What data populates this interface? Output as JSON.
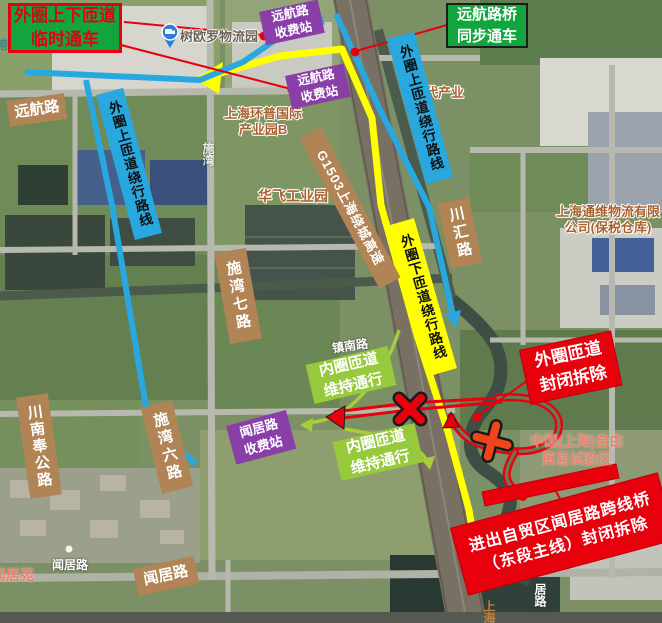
{
  "colors": {
    "notice_green": "#12a53e",
    "closure_red": "#e8000d",
    "detour_blue": "#29a8e0",
    "detour_yellow": "#ffff00",
    "inner_ramp_green": "#97c93d",
    "toll_purple": "#8a3fa8",
    "road_label_brown": "#b08455"
  },
  "notices": {
    "outer_ramps_temp_open": {
      "line1": "外圈上下匝道",
      "line2": "临时通车"
    },
    "bridge_sync_open": {
      "line1": "远航路桥",
      "line2": "同步通车"
    },
    "outer_ramp_closed": {
      "line1": "外圈匝道",
      "line2": "封闭拆除"
    },
    "flyover_closed": {
      "line1": "进出自贸区闻居路跨线桥",
      "line2": "（东段主线）封闭拆除"
    }
  },
  "detour_labels": {
    "outer_on_ramp_left": "外圈上匝道绕行路线",
    "outer_on_ramp_right": "外圈上匝道绕行路线",
    "outer_off_ramp": "外圈下匝道绕行路线",
    "inner_ramp_1": {
      "line1": "内圈匝道",
      "line2": "维持通行"
    },
    "inner_ramp_2": {
      "line1": "内圈匝道",
      "line2": "维持通行"
    }
  },
  "toll_stations": {
    "yuanhang_1": {
      "line1": "远航路",
      "line2": "收费站"
    },
    "yuanhang_2": {
      "line1": "远航路",
      "line2": "收费站"
    },
    "wenju": {
      "line1": "闻居路",
      "line2": "收费站"
    }
  },
  "roads": {
    "yuanhang": "远航路",
    "shiwan7": "施湾七路",
    "shiwan6": "施湾六路",
    "chuannanfeng": "川南奉公路",
    "chuanhui": "川汇路",
    "wenju": "闻居路",
    "g1503": "G1503上海绕城高速"
  },
  "map_texts": {
    "logistics_park": "树欧罗物流园",
    "huanpu_line1": "上海环普国际",
    "huanpu_line2": "产业园B",
    "huafei": "华飞工业园",
    "xiandai": "现代产业",
    "tongwei_line1": "上海通维物流有限",
    "tongwei_line2": "公司(保税仓库)",
    "ftz_line1": "中国(上海)自由",
    "ftz_line2": "贸易试验区",
    "wenjuyuan": "闻居苑",
    "wenju_small": "闻居路",
    "zhennan": "镇南路",
    "shiwan_faint": "施湾",
    "julu_fragment": "居路",
    "shanghai_fragment": "上海",
    "gang_fragment": "港",
    "parking": "P"
  }
}
